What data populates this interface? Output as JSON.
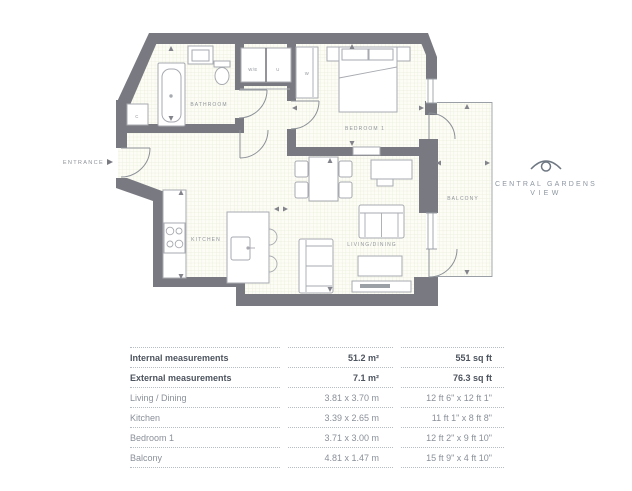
{
  "plan": {
    "entrance_label": "ENTRANCE",
    "rooms": {
      "bathroom": "BATHROOM",
      "bedroom": "BEDROOM 1",
      "kitchen": "KITCHEN",
      "living_dining": "LIVING/DINING",
      "balcony": "BALCONY"
    },
    "closets": {
      "we": "W/E",
      "u": "U",
      "wardrobe": "W",
      "c": "C"
    },
    "colors": {
      "wall": "#797981",
      "floor_grid": "#e9ecda",
      "label_text": "#8f949b"
    }
  },
  "logo": {
    "name_line1": "CENTRAL GARDENS",
    "name_line2": "VIEW"
  },
  "measurements": {
    "rows": [
      {
        "label": "Internal measurements",
        "metric": "51.2 m²",
        "imperial": "551 sq ft"
      },
      {
        "label": "External measurements",
        "metric": "7.1 m²",
        "imperial": "76.3 sq ft"
      },
      {
        "label": "Living / Dining",
        "metric": "3.81 x 3.70 m",
        "imperial": "12 ft 6\" x 12 ft 1\""
      },
      {
        "label": "Kitchen",
        "metric": "3.39 x 2.65 m",
        "imperial": "11 ft 1\" x 8 ft 8\""
      },
      {
        "label": "Bedroom 1",
        "metric": "3.71 x 3.00 m",
        "imperial": "12 ft 2\" x 9 ft 10\""
      },
      {
        "label": "Balcony",
        "metric": "4.81 x 1.47 m",
        "imperial": "15 ft 9\" x 4 ft 10\""
      }
    ]
  }
}
